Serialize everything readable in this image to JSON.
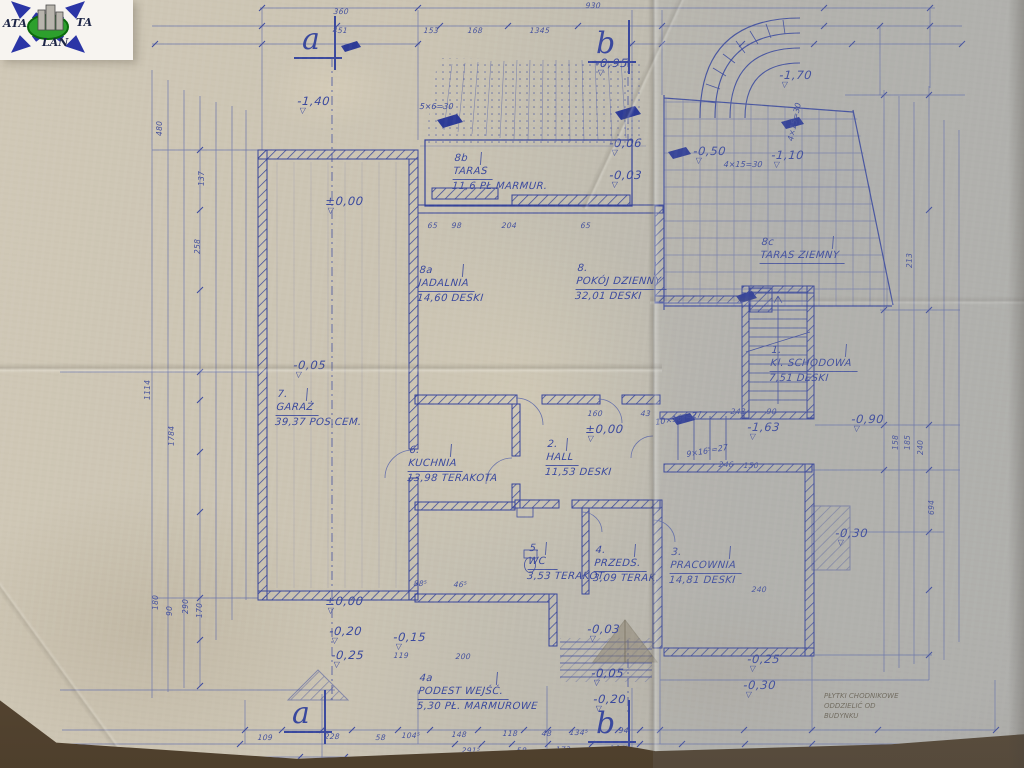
{
  "colors": {
    "ink": "#3b499c",
    "ink_light": "#5c68aa",
    "paper": "#c9c3b4",
    "pencil": "#6e6757",
    "logo_green": "#2da02d",
    "logo_blue": "#2b35a6"
  },
  "icons": {
    "level_triangle": "▽"
  },
  "logo": {
    "left": "ATA",
    "right": "TA",
    "bottom": "LAN"
  },
  "sections": [
    {
      "label": "a",
      "x": 302,
      "y": 26
    },
    {
      "label": "b",
      "x": 596,
      "y": 30
    },
    {
      "label": "a",
      "x": 292,
      "y": 700
    },
    {
      "label": "b",
      "x": 596,
      "y": 710
    }
  ],
  "rooms": [
    {
      "num": "8b",
      "name": "TARAS",
      "area": "11,6",
      "floor": "PŁ.MARMUR.",
      "x": 455,
      "y": 152
    },
    {
      "num": "8a",
      "name": "JADALNIA",
      "area": "14,60",
      "floor": "DESKI",
      "x": 420,
      "y": 264
    },
    {
      "num": "8.",
      "name": "POKÓJ DZIENNY",
      "area": "32,01",
      "floor": "DESKI",
      "x": 578,
      "y": 262
    },
    {
      "num": "8c",
      "name": "TARAS ZIEMNY",
      "area": "",
      "floor": "",
      "x": 762,
      "y": 236
    },
    {
      "num": "1.",
      "name": "Kl. SCHODOWA",
      "area": "7,51",
      "floor": "DESKI",
      "x": 772,
      "y": 344
    },
    {
      "num": "7.",
      "name": "GARAŻ",
      "area": "39,37",
      "floor": "POS.CEM.",
      "x": 278,
      "y": 388
    },
    {
      "num": "6.",
      "name": "KUCHNIA",
      "area": "13,98",
      "floor": "TERAKOTA",
      "x": 410,
      "y": 444
    },
    {
      "num": "2.",
      "name": "HALL",
      "area": "11,53",
      "floor": "DESKI",
      "x": 548,
      "y": 438
    },
    {
      "num": "5.",
      "name": "WC",
      "area": "3,53",
      "floor": "TERAKOT.",
      "x": 530,
      "y": 542
    },
    {
      "num": "4.",
      "name": "PRZEDS.",
      "area": "3,09",
      "floor": "TERAK.",
      "x": 596,
      "y": 544
    },
    {
      "num": "3.",
      "name": "PRACOWNIA",
      "area": "14,81",
      "floor": "DESKI",
      "x": 672,
      "y": 546
    },
    {
      "num": "4a",
      "name": "PODEST WEJŚĆ.",
      "area": "5,30",
      "floor": "PŁ. MARMUROWE",
      "x": 420,
      "y": 672
    }
  ],
  "levels": [
    {
      "v": "-0,95",
      "x": 596,
      "y": 56
    },
    {
      "v": "-1,40",
      "x": 298,
      "y": 94
    },
    {
      "v": "-1,70",
      "x": 780,
      "y": 68
    },
    {
      "v": "-0,50",
      "x": 694,
      "y": 144
    },
    {
      "v": "-1,10",
      "x": 772,
      "y": 148
    },
    {
      "v": "-0,06",
      "x": 610,
      "y": 136
    },
    {
      "v": "-0,03",
      "x": 610,
      "y": 168
    },
    {
      "v": "±0,00",
      "x": 326,
      "y": 194
    },
    {
      "v": "-0,05",
      "x": 294,
      "y": 358
    },
    {
      "v": "±0,00",
      "x": 586,
      "y": 422
    },
    {
      "v": "-1,63",
      "x": 748,
      "y": 420
    },
    {
      "v": "-0,90",
      "x": 852,
      "y": 412
    },
    {
      "v": "-0,30",
      "x": 836,
      "y": 526
    },
    {
      "v": "±0,00",
      "x": 326,
      "y": 594
    },
    {
      "v": "-0,20",
      "x": 330,
      "y": 624
    },
    {
      "v": "-0,25",
      "x": 332,
      "y": 648
    },
    {
      "v": "-0,15",
      "x": 394,
      "y": 630
    },
    {
      "v": "-0,03",
      "x": 588,
      "y": 622
    },
    {
      "v": "-0,05",
      "x": 592,
      "y": 666
    },
    {
      "v": "-0,20",
      "x": 594,
      "y": 692
    },
    {
      "v": "-0,25",
      "x": 748,
      "y": 652
    },
    {
      "v": "-0,30",
      "x": 744,
      "y": 678
    }
  ],
  "dims": {
    "top": [
      {
        "v": "360",
        "x": 334,
        "y": 7
      },
      {
        "v": "930",
        "x": 586,
        "y": 1
      },
      {
        "v": "451",
        "x": 333,
        "y": 26
      },
      {
        "v": "153",
        "x": 424,
        "y": 26
      },
      {
        "v": "168",
        "x": 468,
        "y": 26
      },
      {
        "v": "1345",
        "x": 530,
        "y": 26
      }
    ],
    "bottom": [
      {
        "v": "109",
        "x": 258,
        "y": 733
      },
      {
        "v": "228",
        "x": 325,
        "y": 732
      },
      {
        "v": "58",
        "x": 376,
        "y": 733
      },
      {
        "v": "104⁵",
        "x": 402,
        "y": 731
      },
      {
        "v": "148",
        "x": 452,
        "y": 730
      },
      {
        "v": "118",
        "x": 503,
        "y": 729
      },
      {
        "v": "48",
        "x": 542,
        "y": 729
      },
      {
        "v": "134⁵",
        "x": 570,
        "y": 728
      },
      {
        "v": "94",
        "x": 619,
        "y": 726
      },
      {
        "v": "291⁵",
        "x": 462,
        "y": 746
      },
      {
        "v": "58",
        "x": 517,
        "y": 746
      },
      {
        "v": "173",
        "x": 556,
        "y": 745
      },
      {
        "v": "164⁵",
        "x": 610,
        "y": 744
      },
      {
        "v": "390",
        "x": 318,
        "y": 759
      },
      {
        "v": "790",
        "x": 500,
        "y": 758
      },
      {
        "v": "360",
        "x": 581,
        "y": 758
      }
    ],
    "left": [
      {
        "v": "480",
        "x": 155,
        "y": 136
      },
      {
        "v": "137",
        "x": 197,
        "y": 186
      },
      {
        "v": "258",
        "x": 193,
        "y": 254
      },
      {
        "v": "1114",
        "x": 143,
        "y": 400
      },
      {
        "v": "1784",
        "x": 167,
        "y": 446
      },
      {
        "v": "180",
        "x": 151,
        "y": 610
      },
      {
        "v": "90",
        "x": 165,
        "y": 616
      },
      {
        "v": "290",
        "x": 181,
        "y": 614
      },
      {
        "v": "170",
        "x": 195,
        "y": 618
      }
    ],
    "right": [
      {
        "v": "213",
        "x": 905,
        "y": 268
      },
      {
        "v": "158",
        "x": 891,
        "y": 450
      },
      {
        "v": "185",
        "x": 903,
        "y": 450
      },
      {
        "v": "240",
        "x": 916,
        "y": 455
      },
      {
        "v": "694",
        "x": 927,
        "y": 515
      }
    ],
    "mid": [
      {
        "v": "65",
        "x": 428,
        "y": 221
      },
      {
        "v": "98",
        "x": 452,
        "y": 221
      },
      {
        "v": "204",
        "x": 502,
        "y": 221
      },
      {
        "v": "65",
        "x": 581,
        "y": 221
      },
      {
        "v": "160",
        "x": 588,
        "y": 409
      },
      {
        "v": "43",
        "x": 641,
        "y": 409
      },
      {
        "v": "243",
        "x": 731,
        "y": 407
      },
      {
        "v": "90",
        "x": 767,
        "y": 407
      },
      {
        "v": "246",
        "x": 719,
        "y": 460
      },
      {
        "v": "150",
        "x": 744,
        "y": 461
      },
      {
        "v": "88⁵",
        "x": 414,
        "y": 579
      },
      {
        "v": "46⁵",
        "x": 454,
        "y": 580
      },
      {
        "v": "119",
        "x": 394,
        "y": 651
      },
      {
        "v": "200",
        "x": 456,
        "y": 652
      },
      {
        "v": "240",
        "x": 752,
        "y": 585
      }
    ]
  },
  "stair_notes": [
    {
      "v": "5×6=30",
      "x": 420,
      "y": 102,
      "rot": 0
    },
    {
      "v": "4×15=30",
      "x": 724,
      "y": 160,
      "rot": 0
    },
    {
      "v": "4×15=30",
      "x": 786,
      "y": 140,
      "rot": -78
    },
    {
      "v": "10×16⁵=27",
      "x": 655,
      "y": 418,
      "rot": -10
    },
    {
      "v": "9×16⁵=27",
      "x": 686,
      "y": 450,
      "rot": -10
    }
  ],
  "pencil_note": {
    "lines": [
      "PŁYTKI CHODNIKOWE",
      "ODDZIELIĆ OD",
      "BUDYNKU"
    ],
    "x": 824,
    "y": 692
  }
}
